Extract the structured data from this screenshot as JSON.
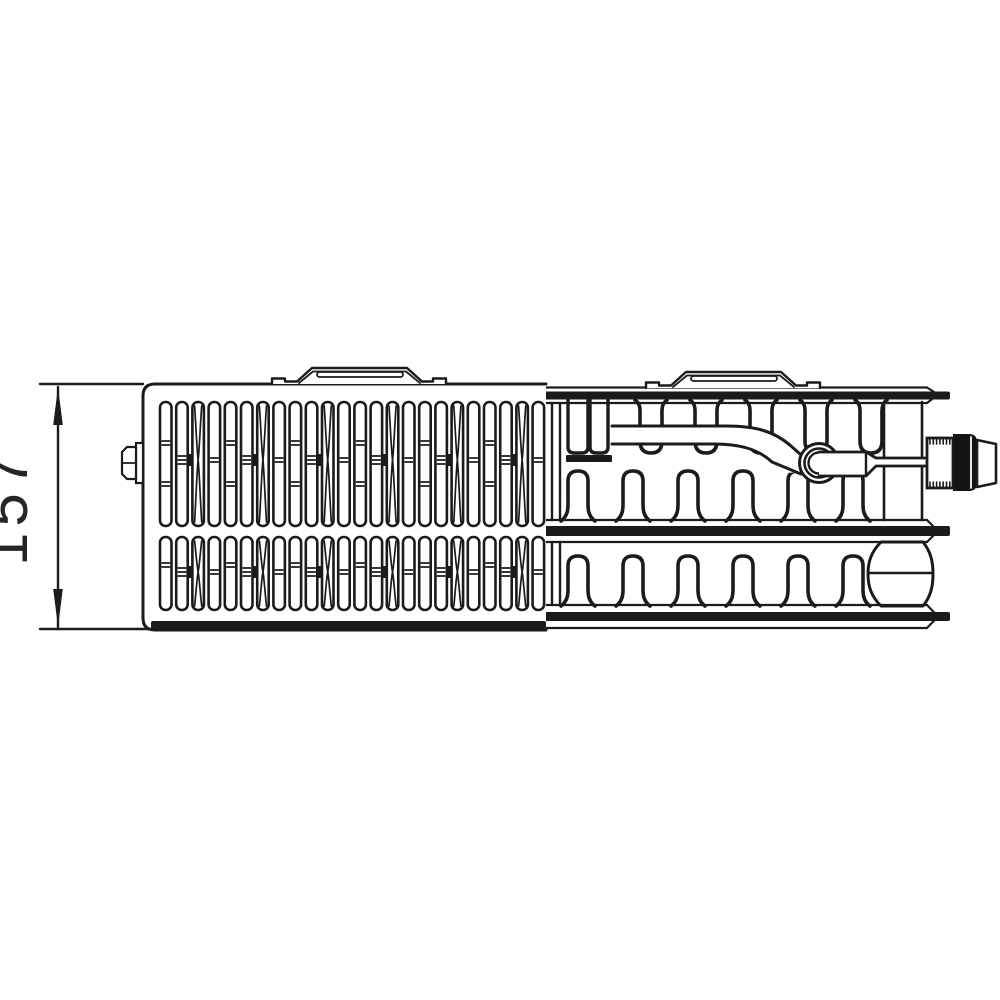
{
  "diagram": {
    "title": "radiator-top-view-technical-drawing",
    "dimension_label": "157",
    "colors": {
      "stroke": "#1b1b1b",
      "background": "#ffffff",
      "text": "#262626"
    },
    "dim": {
      "x": 58,
      "top": 387,
      "bottom": 627,
      "ext_left": 40,
      "label_x": 27,
      "label_y": 507,
      "font_size": 60,
      "letter_spacing": 6,
      "arrow_len": 38,
      "arrow_half": 4.8
    },
    "grille": {
      "x": 143,
      "y": 384,
      "right": 546,
      "bottom": 630,
      "corner": 12,
      "thick_top": 621,
      "slat_start": 160,
      "pitch": 16.2,
      "slat_w": 11.5,
      "count": 24,
      "row1": {
        "top": 402,
        "bottom": 526,
        "waist": 460,
        "p0": [
          441,
          445,
          482,
          486
        ],
        "p1": [
          456,
          460,
          464
        ],
        "p3": [
          458,
          462
        ],
        "conn_y": 454
      },
      "row2": {
        "top": 537,
        "bottom": 610,
        "waist": 572,
        "p0": [
          563,
          567
        ],
        "p1": [
          568,
          572,
          576
        ],
        "p3": [
          570,
          574
        ],
        "conn_y": 566
      }
    },
    "section": {
      "left": 541,
      "line_end": 927,
      "point_x": 938,
      "stub_end": 950,
      "top_band": {
        "l1": 387.5,
        "bar_t": 391.5,
        "bar_b": 399.5,
        "l2": 403,
        "apex": 394.5
      },
      "mid_band": {
        "l1": 520,
        "bar_t": 526,
        "bar_b": 536,
        "l2": 542,
        "apex": 531
      },
      "bot_band": {
        "l1": 605,
        "bar_t": 612,
        "bar_b": 621,
        "l2": 628,
        "apex": 616.5
      },
      "left_channel_x": [
        552,
        560
      ],
      "hang_centers": [
        651,
        706,
        761,
        816,
        871
      ],
      "hang_top": 400,
      "hang_bottom": 453,
      "up_centers": [
        578,
        633,
        688,
        743,
        798,
        853
      ],
      "up_base_top": 521,
      "up_base_bot": 606,
      "up_height": 50,
      "special_rects": [
        [
          568,
          588
        ],
        [
          590,
          608
        ]
      ],
      "special_bottom": 453,
      "plate": [
        566,
        455,
        612,
        462
      ],
      "channel": {
        "x1": 884,
        "x2": 922,
        "y1": 402,
        "y2": 520
      },
      "bulge": {
        "x1": 868,
        "x2": 933,
        "top": 542,
        "bottom": 606,
        "mid_y": 573
      }
    },
    "pipe": {
      "start_x": 612,
      "top_y": 426,
      "bot_y": 444
    },
    "ring": {
      "cx": 819,
      "cy": 463,
      "radii": [
        19.5,
        14.5,
        10.5
      ]
    },
    "valve": {
      "big_pipe": {
        "x1": 819,
        "x2": 866,
        "y1": 452,
        "y2": 476,
        "taper_x": 876
      },
      "small_pipe": {
        "y1": 458,
        "y2": 466,
        "x2": 927
      },
      "block": [
        927,
        438,
        953,
        488
      ],
      "threads": 7,
      "thread_h": 6,
      "knob": [
        953,
        434,
        977,
        491
      ],
      "slit_x": 971,
      "cap": [
        977,
        440,
        996,
        444,
        483,
        487
      ]
    },
    "brackets": [
      {
        "x0": 272,
        "base": 384
      },
      {
        "x0": 646,
        "base": 388
      }
    ],
    "bracket_profile": {
      "width": 174,
      "foot_w": 13,
      "foot_h": 5.5,
      "slope_in": 25,
      "slope_top": 40,
      "plateau_end": 135,
      "height": 16,
      "lens": [
        45,
        131,
        12,
        7
      ]
    },
    "plug": {
      "tab": [
        136,
        443,
        143,
        483
      ],
      "body_left": 122,
      "body_top": 447,
      "body_bottom": 479,
      "chamfer": 5,
      "mid_y": 463
    }
  }
}
